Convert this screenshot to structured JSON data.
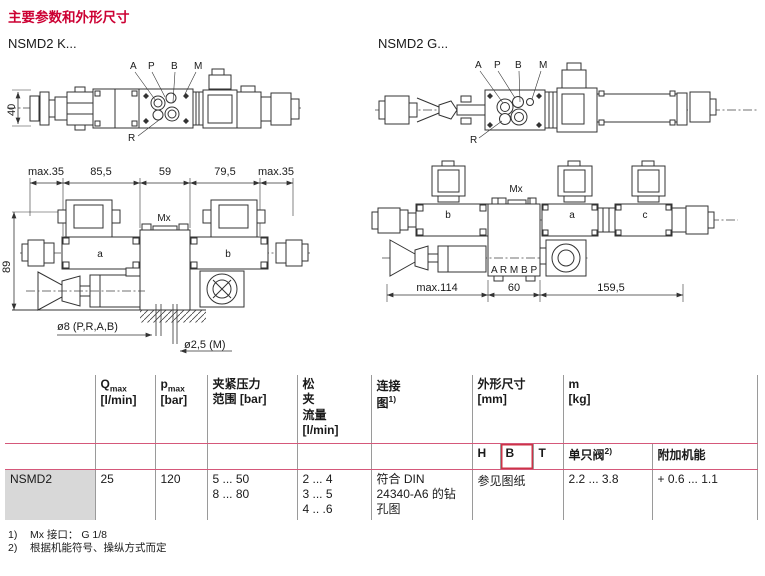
{
  "page": {
    "title": "主要参数和外形尺寸"
  },
  "drawings": {
    "k": {
      "label": "NSMD2 K...",
      "ports": [
        "A",
        "P",
        "B",
        "M"
      ],
      "port_r": "R",
      "dim_height": "40"
    },
    "g": {
      "label": "NSMD2 G...",
      "ports": [
        "A",
        "P",
        "B",
        "M"
      ],
      "port_r": "R"
    },
    "front": {
      "dims_top": [
        "max.35",
        "85,5",
        "59",
        "79,5",
        "max.35"
      ],
      "dim_height": "89",
      "mx": "Mx",
      "label_a": "a",
      "label_b": "b",
      "hole_note": "ø8  (P,R,A,B)",
      "hole_note_m": "ø2,5  (M)"
    },
    "side": {
      "mx": "Mx",
      "coil_a": "a",
      "coil_b": "b",
      "coil_c": "c",
      "ports": "A R M B P",
      "dim_left": "max.114",
      "dim_mid": "60",
      "dim_right": "159,5"
    }
  },
  "table": {
    "h_q": "Q",
    "h_q_sub": "max",
    "h_q_unit": "[l/min]",
    "h_p": "p",
    "h_p_sub": "max",
    "h_p_unit": "[bar]",
    "h_clamp": "夹紧压力\n范围 [bar]",
    "h_release": "松\n夹\n流量\n[l/min]",
    "h_conn_1": "连接",
    "h_conn_2": "图",
    "h_conn_sup": "1)",
    "h_dims": "外形尺寸\n[mm]",
    "h_mass": "m\n[kg]",
    "h_H": "H",
    "h_B": "B",
    "h_T": "T",
    "h_single": "单只阀",
    "h_single_sup": "2)",
    "h_addon": "附加机能",
    "row": {
      "model": "NSMD2",
      "qmax": "25",
      "pmax": "120",
      "clamp": "5 ... 50\n8 ... 80",
      "release": "2 ... 4\n3 ... 5\n4 .. .6",
      "conn": "符合 DIN\n24340-A6 的钻\n孔图",
      "dims": "参见图纸",
      "single": "2.2 ... 3.8",
      "addon": "+ 0.6 ... 1.1"
    }
  },
  "footnotes": [
    {
      "num": "1)",
      "text": "Mx 接口： G 1/8"
    },
    {
      "num": "2)",
      "text": "根据机能符号、操纵方式而定"
    }
  ],
  "colors": {
    "accent": "#cc0033",
    "table_line": "#d5587a",
    "grid_line": "#9a9a9a"
  }
}
